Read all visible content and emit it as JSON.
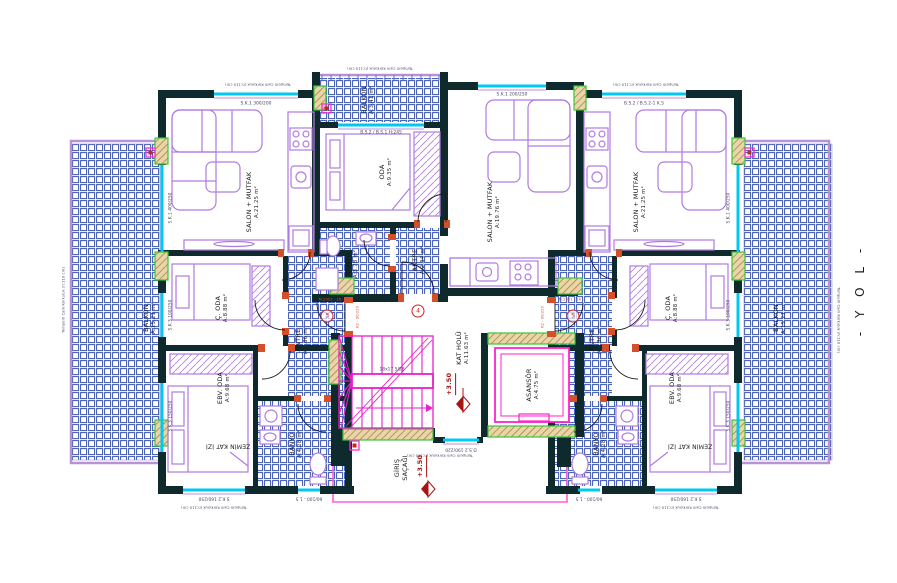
{
  "street_label": "- Y O L -",
  "rooms": {
    "salon_left": {
      "name": "SALON + MUTFAK",
      "area": "A:21.25 m²"
    },
    "balkon_left": {
      "name": "BALKON",
      "area": "A:15.21 m²"
    },
    "coda_left": {
      "name": "Ç. ODA",
      "area": "A:8.88 m²"
    },
    "ebv_oda_left": {
      "name": "EBV. ODA",
      "area": "A:9.68 m²"
    },
    "antre_left": {
      "name": "ANTRE",
      "area": "A:4.86 m²"
    },
    "banyo_left": {
      "name": "BANYO",
      "area": "A:4.28 m²"
    },
    "balkon_mid": {
      "name": "BALKON",
      "area": "A:3.41 m²"
    },
    "oda_mid": {
      "name": "ODA",
      "area": "A:9.35 m²"
    },
    "banyo_mid": {
      "name": "BANYO",
      "area": "A:3.78 m²"
    },
    "antre_mid": {
      "name": "ANTRE",
      "area": "A:2.34 m²"
    },
    "salon_mid": {
      "name": "SALON + MUTFAK",
      "area": "A:19.76 m²"
    },
    "salon_right": {
      "name": "SALON + MUTFAK",
      "area": "A:21.25 m²"
    },
    "balkon_right": {
      "name": "BALKON",
      "area": "A:15.21 m²"
    },
    "coda_right": {
      "name": "Ç. ODA",
      "area": "A:8.88 m²"
    },
    "ebv_oda_right": {
      "name": "EBV. ODA",
      "area": "A:9.68 m²"
    },
    "antre_right": {
      "name": "ANTRE",
      "area": "A:4.86 m²"
    },
    "banyo_right": {
      "name": "BANYO",
      "area": "A:4.28 m²"
    },
    "kat_holu": {
      "name": "KAT HOLÜ",
      "area": "A:11.63 m²"
    },
    "asansor": {
      "name": "ASANSÖR",
      "area": "A:4.75 m²"
    }
  },
  "levels": {
    "hall": "+3.50",
    "entrance": "+3.50"
  },
  "entrance": {
    "line1": "GİRİŞ",
    "line2": "SAÇAĞI"
  },
  "floor_trace": "ZEMİN KAT İZİ",
  "stair_note": "18x17.5/28",
  "annotations": {
    "railing": "Temperli Cam Korkuluk (h:110 cm)"
  },
  "windows": {
    "top_left": "S.K.1 300/200",
    "top_mid": "S.K.1 200/250",
    "top_right": "B.S.2 / B.S.2-1 K.5",
    "balkon_mid": "B.S.2 / B.S.1 H:245",
    "balcony_door": "S.K.1 400/250",
    "room_side": "S.K.3 100/250",
    "room_side_low": "S.K.3 150/250",
    "bottom": "S.K.2 160/250",
    "bath": "60/100 - 1.5",
    "hall": "D.S.2 190/220"
  },
  "doors": {
    "type_label": "K2 - 90/220",
    "code_label": "M.2001 - 1K",
    "numbers": {
      "left": "3",
      "middle": "4",
      "right": "5"
    }
  },
  "colors": {
    "wall": "#0f2a2d",
    "tile": "#3a55ad",
    "furniture": "#b07ce0",
    "window": "#00c8f0",
    "door": "#d4502a",
    "column": "#e9d5a7",
    "column_border": "#37c837",
    "stair": "#e820c8",
    "elevator": "#ff22cc",
    "canopy": "#ff5fd7",
    "marker": "#a81313",
    "railing": "#b892d6"
  }
}
